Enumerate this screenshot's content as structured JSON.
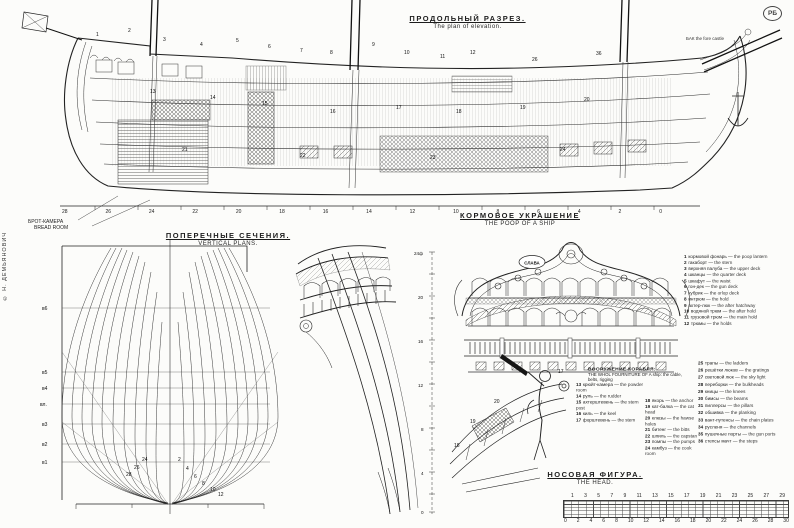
{
  "meta": {
    "logo": "РБ",
    "copyright": "© Н. ДЕМЬЯНОВИЧ"
  },
  "titles": {
    "elevation_ru": "ПРОДОЛЬНЫЙ РАЗРЕЗ.",
    "elevation_en": "The plan of elevation.",
    "sections_ru": "ПОПЕРЕЧНЫЕ СЕЧЕНИЯ.",
    "sections_en": "VERTICAL PLANS.",
    "poop_ru": "КОРМОВОЕ УКРАШЕНИЕ",
    "poop_en": "THE POOP OF A SHIP",
    "head_ru": "НОСОВАЯ ФИГУРА.",
    "head_en": "THE HEAD."
  },
  "labels": {
    "bread_room_ru": "БРОТ-КАМЕРА",
    "bread_room_en": "BREAD ROOM",
    "stern_plate": "СЛАВА",
    "bow_note_ru": "БАК",
    "bow_note_en": "the fore castle",
    "waterlines": [
      "в6",
      "в5",
      "в4",
      "вл.",
      "в3",
      "в2",
      "в1"
    ],
    "quarter_ruler": [
      "24ф",
      "20",
      "16",
      "12",
      "8",
      "4",
      "0"
    ]
  },
  "frame_numbers": [
    "28",
    "26",
    "24",
    "22",
    "20",
    "18",
    "16",
    "14",
    "12",
    "10",
    "8",
    "6",
    "4",
    "2",
    "0"
  ],
  "scale_bar": {
    "top": [
      "1",
      "3",
      "5",
      "7",
      "9",
      "11",
      "13",
      "15",
      "17",
      "19",
      "21",
      "23",
      "25",
      "27",
      "29"
    ],
    "bottom": [
      "0",
      "2",
      "4",
      "6",
      "8",
      "10",
      "12",
      "14",
      "16",
      "18",
      "20",
      "22",
      "24",
      "26",
      "28",
      "30"
    ]
  },
  "legend": {
    "heading_ru": "ВООРУЖЕНИЕ КОРАБЛЯ:",
    "heading_en": "THE WHOL FOURNITURE OF A ship: the cable, belts, rigging",
    "group_a": {
      "items": [
        {
          "n": "1",
          "ru": "кормовой фонарь",
          "en": "the poop lantern"
        },
        {
          "n": "2",
          "ru": "гакаборт",
          "en": "the stern"
        },
        {
          "n": "3",
          "ru": "верхняя палуба",
          "en": "the upper deck"
        },
        {
          "n": "4",
          "ru": "шканцы",
          "en": "the quarter deck"
        },
        {
          "n": "5",
          "ru": "шкафут",
          "en": "the waist"
        },
        {
          "n": "6",
          "ru": "гон-дек",
          "en": "the gun deck"
        },
        {
          "n": "7",
          "ru": "кубрик",
          "en": "the orlop deck"
        },
        {
          "n": "8",
          "ru": "интрюм",
          "en": "the hold"
        },
        {
          "n": "9",
          "ru": "ахтер-люк",
          "en": "the after hatchway"
        },
        {
          "n": "10",
          "ru": "водяной трюм",
          "en": "the after hold"
        },
        {
          "n": "11",
          "ru": "грузовой трюм",
          "en": "the main hold"
        },
        {
          "n": "12",
          "ru": "трюмы",
          "en": "the holds"
        }
      ]
    },
    "group_b": {
      "items": [
        {
          "n": "13",
          "ru": "крюйт-камера",
          "en": "the powder room"
        },
        {
          "n": "14",
          "ru": "руль",
          "en": "the rudder"
        },
        {
          "n": "15",
          "ru": "ахтерштевень",
          "en": "the stern post"
        },
        {
          "n": "16",
          "ru": "киль",
          "en": "the keel"
        },
        {
          "n": "17",
          "ru": "форштевень",
          "en": "the stem"
        }
      ]
    },
    "group_c": {
      "items": [
        {
          "n": "18",
          "ru": "якорь",
          "en": "the anchor"
        },
        {
          "n": "19",
          "ru": "кат-балка",
          "en": "the cat head"
        },
        {
          "n": "20",
          "ru": "клюзы",
          "en": "the hawse holes"
        },
        {
          "n": "21",
          "ru": "битенг",
          "en": "the bitts"
        },
        {
          "n": "22",
          "ru": "шпиль",
          "en": "the capstan"
        },
        {
          "n": "23",
          "ru": "помпы",
          "en": "the pumps"
        },
        {
          "n": "24",
          "ru": "камбуз",
          "en": "the cook room"
        }
      ]
    },
    "group_d": {
      "items": [
        {
          "n": "25",
          "ru": "трапы",
          "en": "the ladders"
        },
        {
          "n": "26",
          "ru": "решётки люков",
          "en": "the gratings"
        },
        {
          "n": "27",
          "ru": "световой люк",
          "en": "the sky light"
        },
        {
          "n": "28",
          "ru": "переборки",
          "en": "the bulkheads"
        },
        {
          "n": "29",
          "ru": "кницы",
          "en": "the knees"
        },
        {
          "n": "30",
          "ru": "бимсы",
          "en": "the beams"
        },
        {
          "n": "31",
          "ru": "пиллерсы",
          "en": "the pillars"
        },
        {
          "n": "32",
          "ru": "обшивка",
          "en": "the planking"
        },
        {
          "n": "33",
          "ru": "вант-путенсы",
          "en": "the chain plates"
        },
        {
          "n": "34",
          "ru": "русленя",
          "en": "the channels"
        },
        {
          "n": "35",
          "ru": "пушечные порты",
          "en": "the gun ports"
        },
        {
          "n": "36",
          "ru": "степсы мачт",
          "en": "the steps"
        }
      ]
    }
  },
  "callouts": {
    "elevation": [
      {
        "t": "1",
        "x": 96,
        "y": 33
      },
      {
        "t": "2",
        "x": 128,
        "y": 29
      },
      {
        "t": "3",
        "x": 163,
        "y": 38
      },
      {
        "t": "4",
        "x": 200,
        "y": 43
      },
      {
        "t": "5",
        "x": 236,
        "y": 39
      },
      {
        "t": "6",
        "x": 268,
        "y": 45
      },
      {
        "t": "7",
        "x": 300,
        "y": 49
      },
      {
        "t": "8",
        "x": 330,
        "y": 51
      },
      {
        "t": "9",
        "x": 372,
        "y": 43
      },
      {
        "t": "10",
        "x": 404,
        "y": 51
      },
      {
        "t": "11",
        "x": 440,
        "y": 55
      },
      {
        "t": "12",
        "x": 470,
        "y": 51
      },
      {
        "t": "26",
        "x": 532,
        "y": 58
      },
      {
        "t": "36",
        "x": 596,
        "y": 52
      },
      {
        "t": "13",
        "x": 150,
        "y": 90
      },
      {
        "t": "14",
        "x": 210,
        "y": 96
      },
      {
        "t": "15",
        "x": 262,
        "y": 102
      },
      {
        "t": "16",
        "x": 330,
        "y": 110
      },
      {
        "t": "17",
        "x": 396,
        "y": 106
      },
      {
        "t": "18",
        "x": 456,
        "y": 110
      },
      {
        "t": "19",
        "x": 520,
        "y": 106
      },
      {
        "t": "20",
        "x": 584,
        "y": 98
      },
      {
        "t": "21",
        "x": 182,
        "y": 148
      },
      {
        "t": "22",
        "x": 300,
        "y": 154
      },
      {
        "t": "23",
        "x": 430,
        "y": 156
      },
      {
        "t": "24",
        "x": 560,
        "y": 148
      }
    ],
    "bodyplan": [
      {
        "t": "2",
        "x": 166,
        "y": 226
      },
      {
        "t": "4",
        "x": 174,
        "y": 235
      },
      {
        "t": "6",
        "x": 182,
        "y": 243
      },
      {
        "t": "8",
        "x": 190,
        "y": 250
      },
      {
        "t": "10",
        "x": 198,
        "y": 256
      },
      {
        "t": "12",
        "x": 206,
        "y": 261
      },
      {
        "t": "24",
        "x": 130,
        "y": 226
      },
      {
        "t": "26",
        "x": 122,
        "y": 234
      },
      {
        "t": "28",
        "x": 114,
        "y": 241
      }
    ],
    "head": [
      {
        "t": "17",
        "x": 116,
        "y": 14
      },
      {
        "t": "18",
        "x": 12,
        "y": 88
      },
      {
        "t": "19",
        "x": 28,
        "y": 64
      },
      {
        "t": "20",
        "x": 52,
        "y": 44
      }
    ]
  }
}
